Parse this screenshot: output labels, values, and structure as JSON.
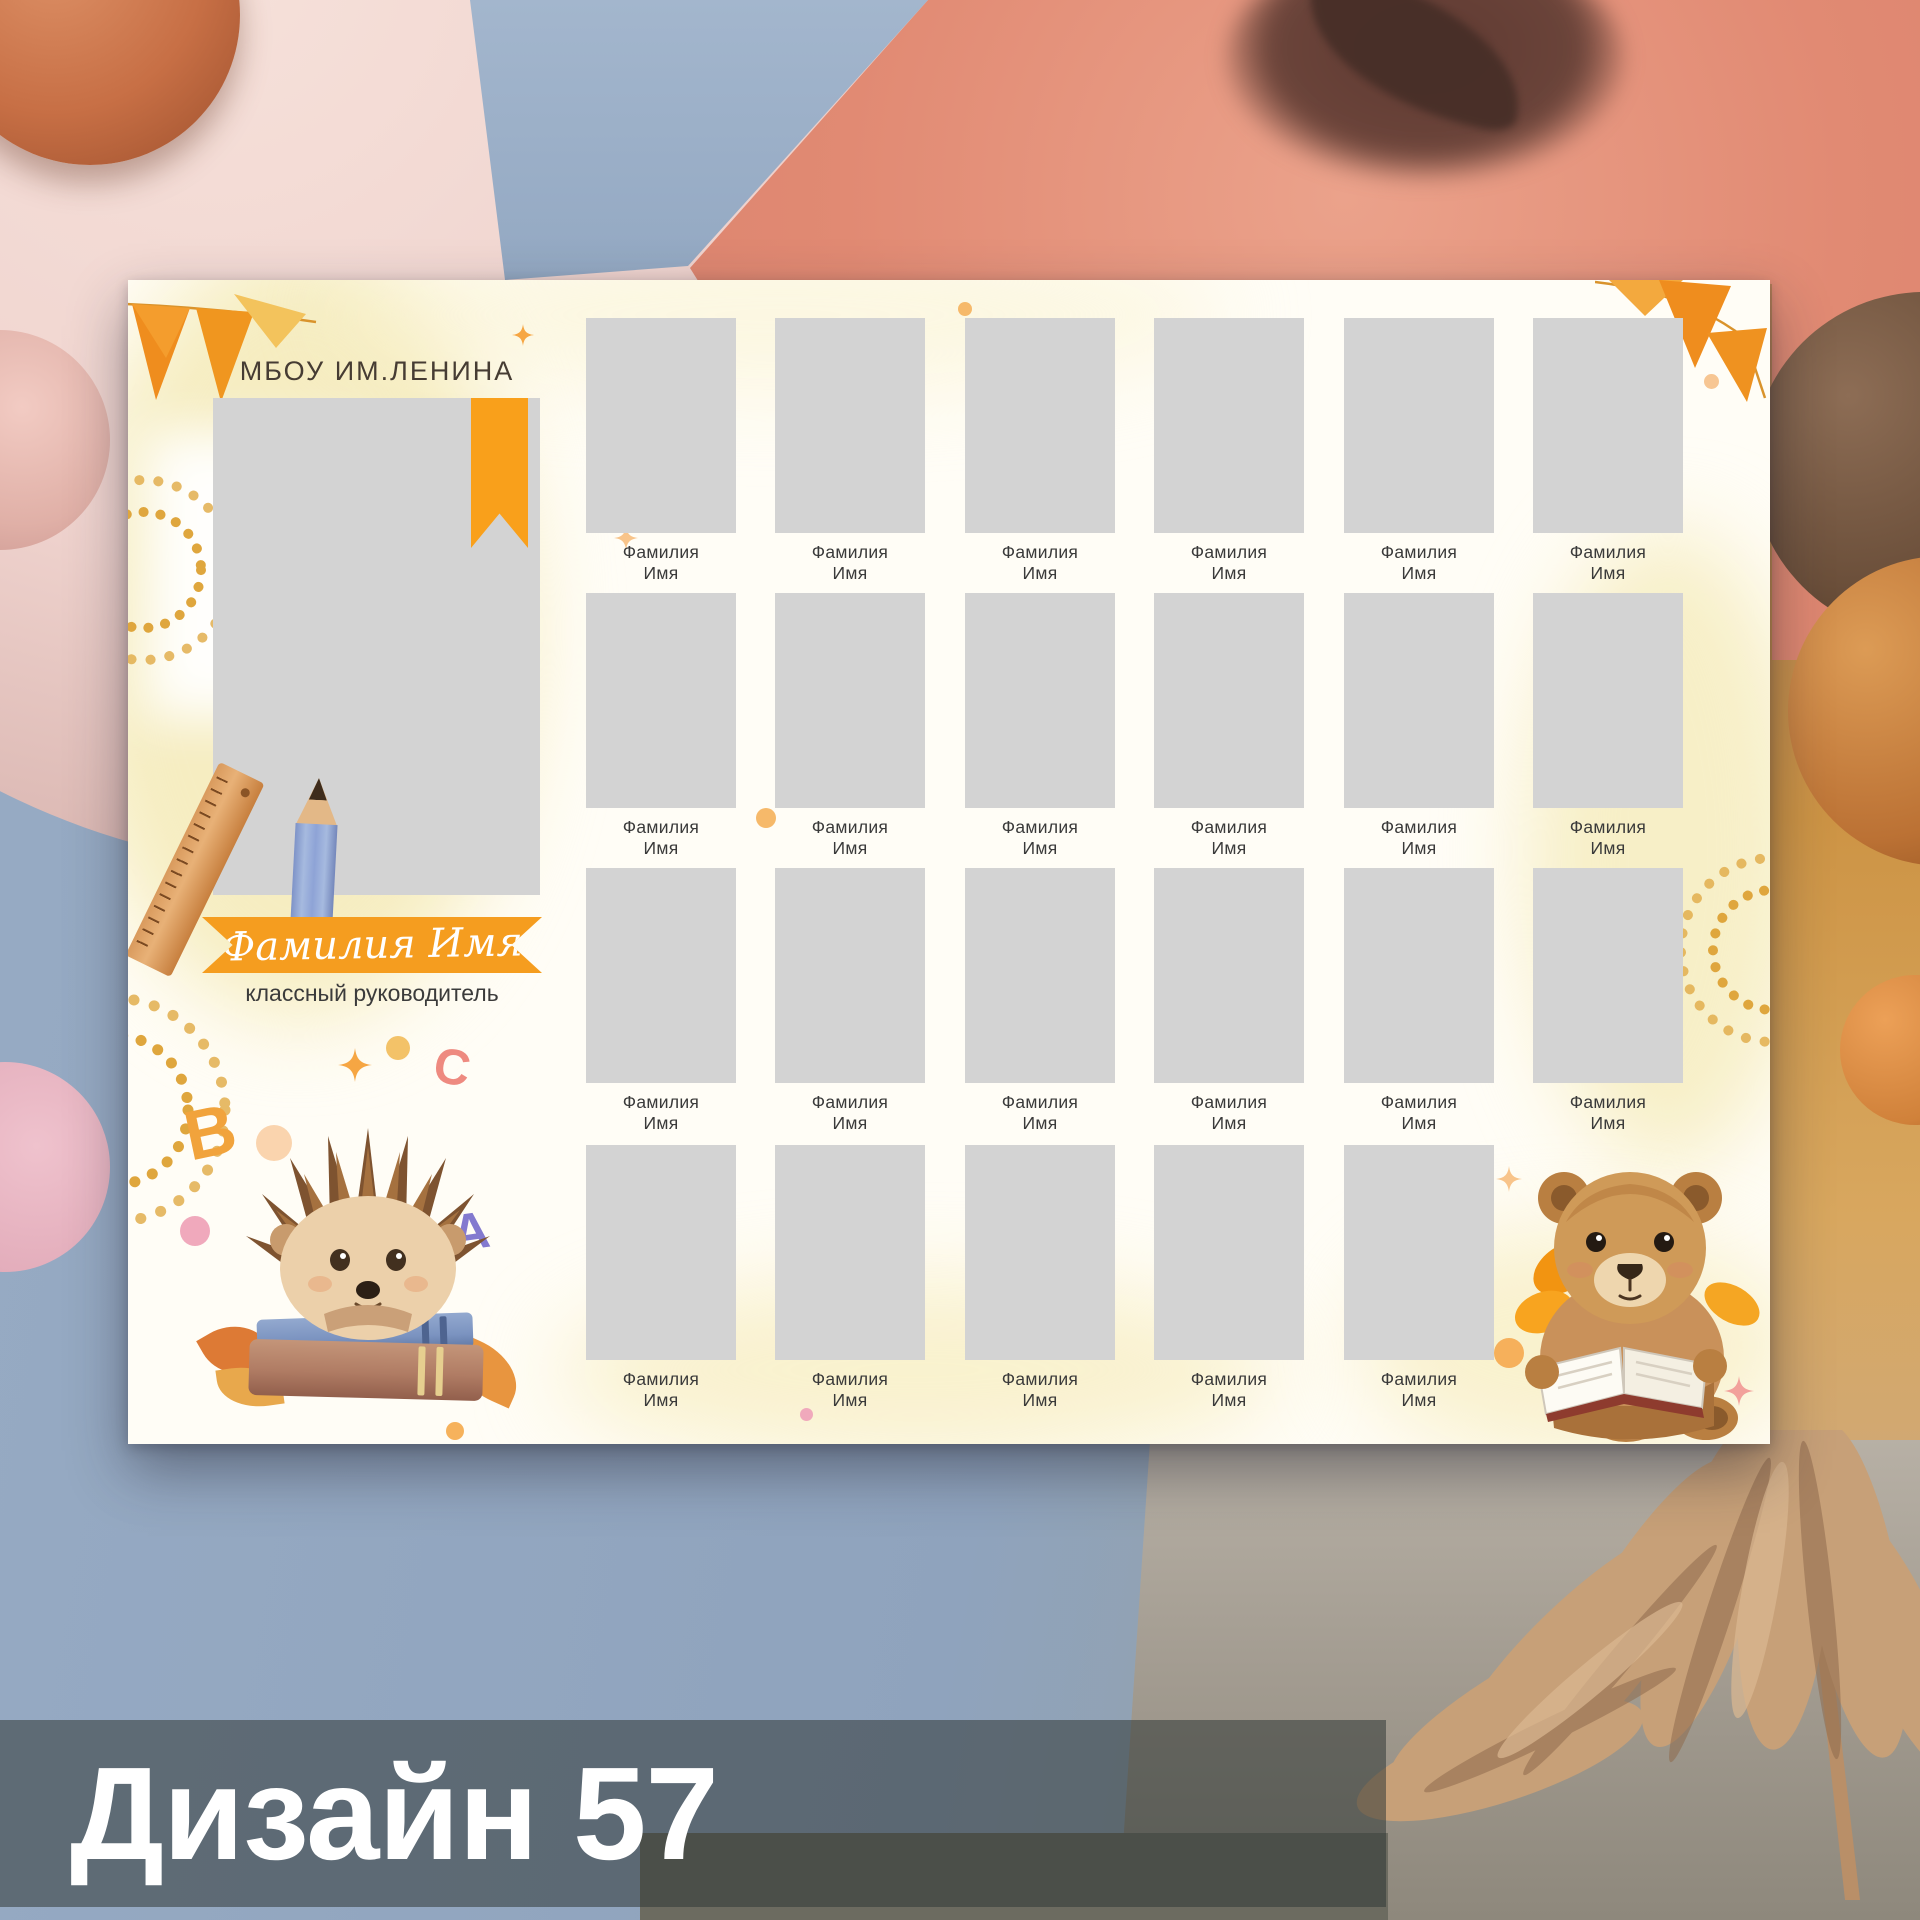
{
  "design_label": "Дизайн 57",
  "poster": {
    "school_name": "МБОУ ИМ.ЛЕНИНА",
    "teacher": {
      "name": "Фамилия Имя",
      "role": "классный руководитель"
    },
    "decor_letters": [
      "B",
      "C",
      "А"
    ],
    "students": [
      {
        "surname": "Фамилия",
        "name": "Имя"
      },
      {
        "surname": "Фамилия",
        "name": "Имя"
      },
      {
        "surname": "Фамилия",
        "name": "Имя"
      },
      {
        "surname": "Фамилия",
        "name": "Имя"
      },
      {
        "surname": "Фамилия",
        "name": "Имя"
      },
      {
        "surname": "Фамилия",
        "name": "Имя"
      },
      {
        "surname": "Фамилия",
        "name": "Имя"
      },
      {
        "surname": "Фамилия",
        "name": "Имя"
      },
      {
        "surname": "Фамилия",
        "name": "Имя"
      },
      {
        "surname": "Фамилия",
        "name": "Имя"
      },
      {
        "surname": "Фамилия",
        "name": "Имя"
      },
      {
        "surname": "Фамилия",
        "name": "Имя"
      },
      {
        "surname": "Фамилия",
        "name": "Имя"
      },
      {
        "surname": "Фамилия",
        "name": "Имя"
      },
      {
        "surname": "Фамилия",
        "name": "Имя"
      },
      {
        "surname": "Фамилия",
        "name": "Имя"
      },
      {
        "surname": "Фамилия",
        "name": "Имя"
      },
      {
        "surname": "Фамилия",
        "name": "Имя"
      },
      {
        "surname": "Фамилия",
        "name": "Имя"
      },
      {
        "surname": "Фамилия",
        "name": "Имя"
      },
      {
        "surname": "Фамилия",
        "name": "Имя"
      },
      {
        "surname": "Фамилия",
        "name": "Имя"
      },
      {
        "surname": "Фамилия",
        "name": "Имя"
      }
    ]
  },
  "colors": {
    "accent_orange": "#f59d1f",
    "photo_placeholder": "#d3d3d3",
    "poster_background": "#fffdf6",
    "caption_text": "#3a3a3a",
    "footer_bar": "rgba(49,56,54,0.55)",
    "footer_text": "#ffffff"
  }
}
